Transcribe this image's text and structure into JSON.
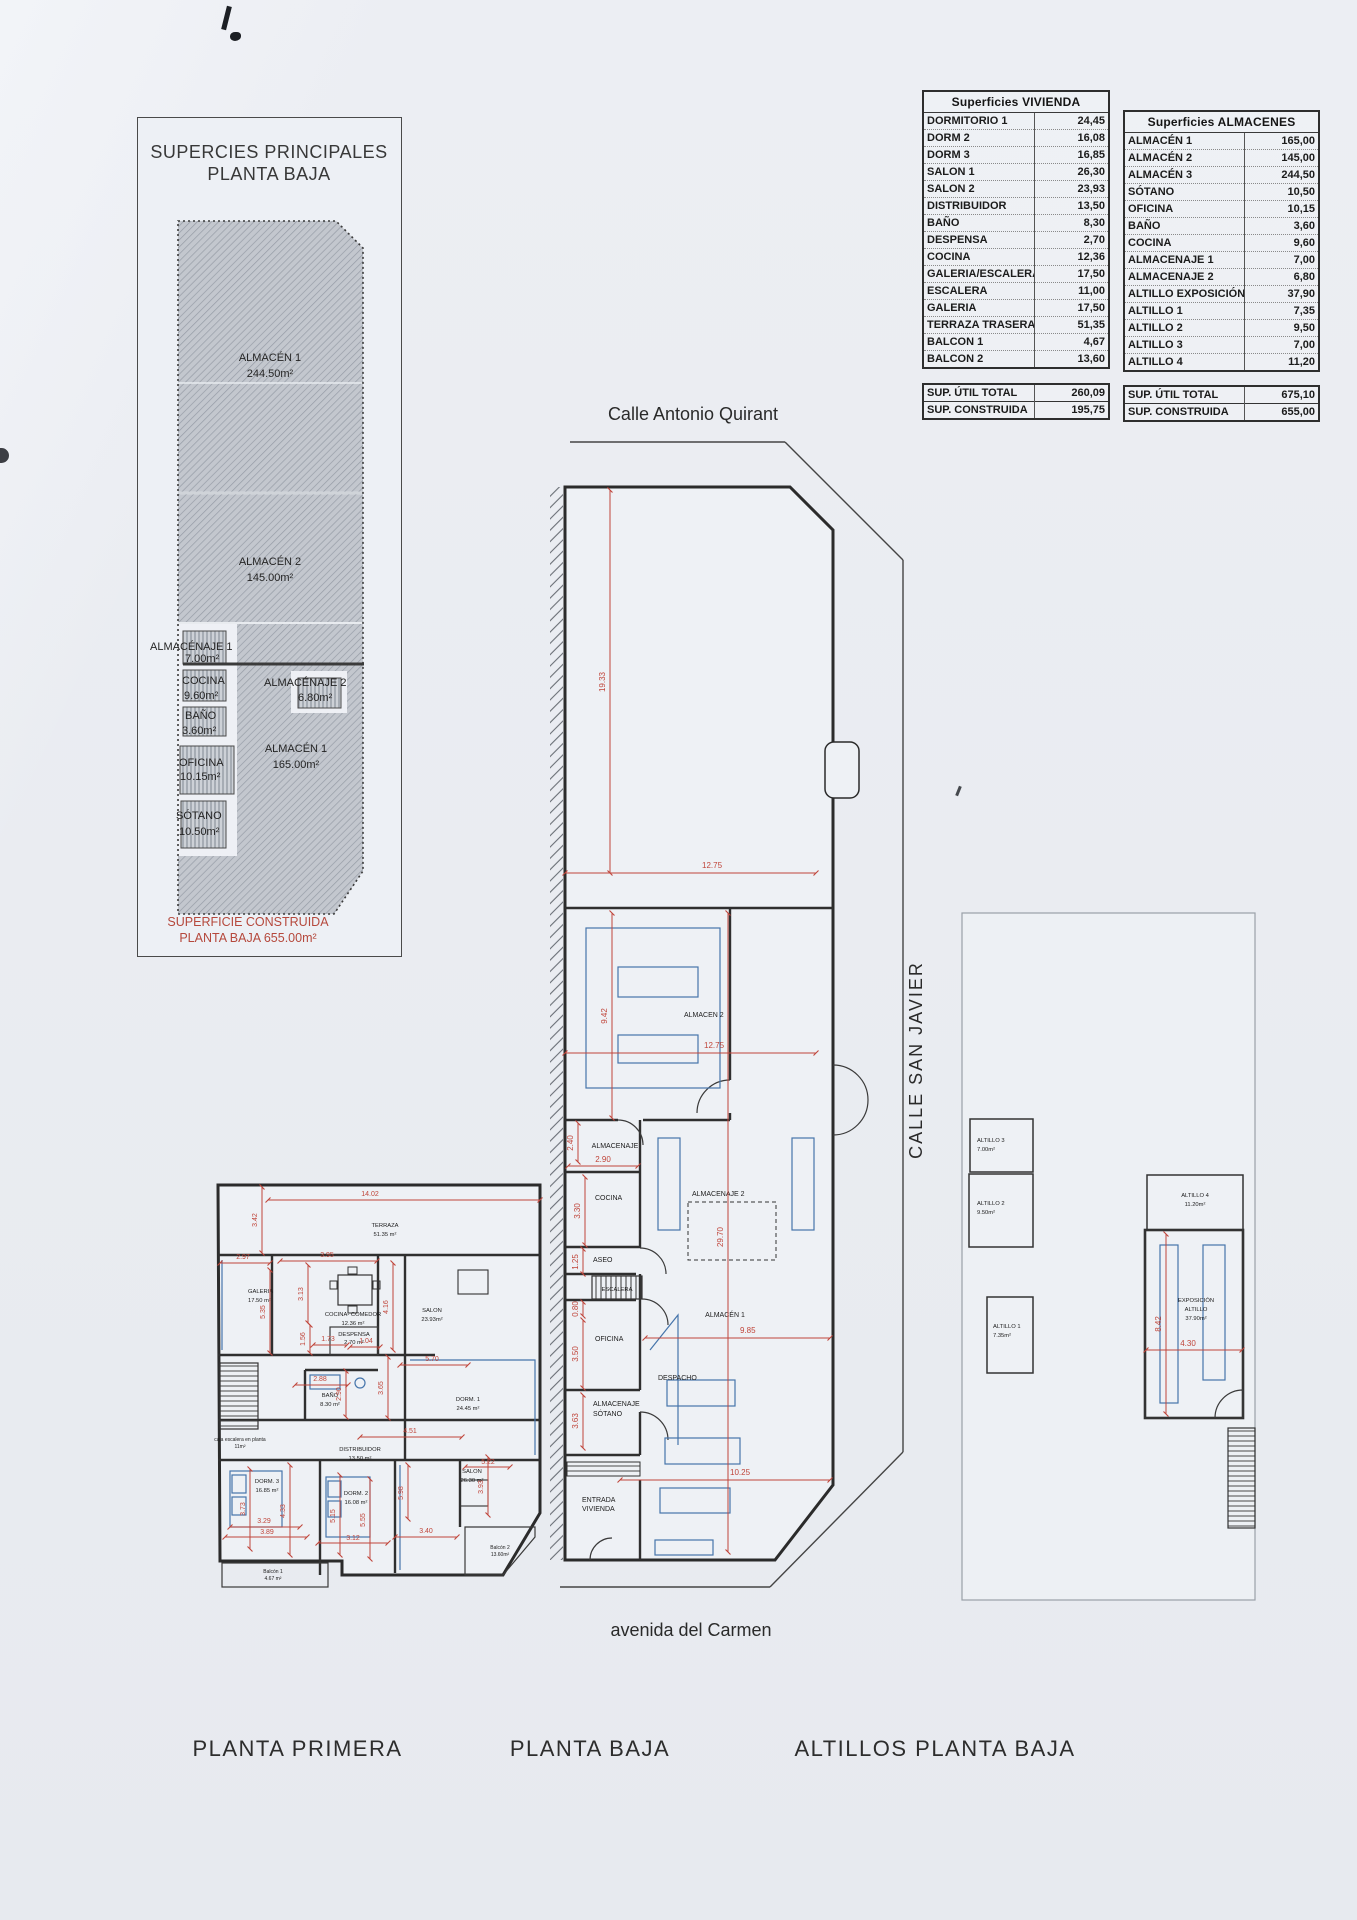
{
  "site_diagram": {
    "title1": "SUPERCIES PRINCIPALES",
    "title2": "PLANTA BAJA",
    "rooms": {
      "a1": {
        "name": "ALMACÉN 1",
        "area": "244.50m²"
      },
      "a2": {
        "name": "ALMACÉN 2",
        "area": "145.00m²"
      },
      "aje1": {
        "name": "ALMACÉNAJE 1",
        "area": "7.00m²"
      },
      "cocina": {
        "name": "COCINA",
        "area": "9.60m²"
      },
      "aje2": {
        "name": "ALMACÉNAJE 2",
        "area": "6.80m²"
      },
      "bano": {
        "name": "BAÑO",
        "area": "3.60m²"
      },
      "a1b": {
        "name": "ALMACÉN 1",
        "area": "165.00m²"
      },
      "oficina": {
        "name": "OFICINA",
        "area": "10.15m²"
      },
      "sotano": {
        "name": "SÓTANO",
        "area": "10.50m²"
      }
    },
    "footer1": "SUPERFICIE CONSTRUIDA",
    "footer2": "PLANTA BAJA 655.00m²"
  },
  "tables": {
    "vivienda": {
      "title": "Superficies VIVIENDA",
      "rows": [
        [
          "DORMITORIO 1",
          "24,45"
        ],
        [
          "DORM 2",
          "16,08"
        ],
        [
          "DORM 3",
          "16,85"
        ],
        [
          "SALON 1",
          "26,30"
        ],
        [
          "SALON 2",
          "23,93"
        ],
        [
          "DISTRIBUIDOR",
          "13,50"
        ],
        [
          "BAÑO",
          "8,30"
        ],
        [
          "DESPENSA",
          "2,70"
        ],
        [
          "COCINA",
          "12,36"
        ],
        [
          "GALERIA/ESCALERA",
          "17,50"
        ],
        [
          "ESCALERA",
          "11,00"
        ],
        [
          "GALERIA",
          "17,50"
        ],
        [
          "TERRAZA TRASERA",
          "51,35"
        ],
        [
          "BALCON 1",
          "4,67"
        ],
        [
          "BALCON 2",
          "13,60"
        ]
      ],
      "totals": [
        [
          "SUP. ÚTIL TOTAL",
          "260,09"
        ],
        [
          "SUP. CONSTRUIDA",
          "195,75"
        ]
      ]
    },
    "almacenes": {
      "title": "Superficies ALMACENES",
      "rows": [
        [
          "ALMACÉN 1",
          "165,00"
        ],
        [
          "ALMACÉN 2",
          "145,00"
        ],
        [
          "ALMACÉN 3",
          "244,50"
        ],
        [
          "SÓTANO",
          "10,50"
        ],
        [
          "OFICINA",
          "10,15"
        ],
        [
          "BAÑO",
          "3,60"
        ],
        [
          "COCINA",
          "9,60"
        ],
        [
          "ALMACENAJE 1",
          "7,00"
        ],
        [
          "ALMACENAJE 2",
          "6,80"
        ],
        [
          "ALTILLO EXPOSICIÓN",
          "37,90"
        ],
        [
          "ALTILLO 1",
          "7,35"
        ],
        [
          "ALTILLO 2",
          "9,50"
        ],
        [
          "ALTILLO 3",
          "7,00"
        ],
        [
          "ALTILLO 4",
          "11,20"
        ]
      ],
      "totals": [
        [
          "SUP. ÚTIL TOTAL",
          "675,10"
        ],
        [
          "SUP. CONSTRUIDA",
          "655,00"
        ]
      ]
    }
  },
  "streets": {
    "north": "Calle Antonio Quirant",
    "east": "CALLE SAN JAVIER",
    "south": "avenida del Carmen"
  },
  "plan_titles": {
    "left": "PLANTA PRIMERA",
    "middle": "PLANTA BAJA",
    "right": "ALTILLOS PLANTA BAJA"
  },
  "planta_baja": {
    "labels": {
      "almacen2": "ALMACEN 2",
      "almacenaje": "ALMACENAJE",
      "cocina": "COCINA",
      "aseo": "ASEO",
      "escalera": "ESCALERA",
      "oficina": "OFICINA",
      "despacho": "DESPACHO",
      "almacen1": "ALMACÉN 1",
      "almacenaje2": "ALMACENAJE 2",
      "alm_sotano_1": "ALMACENAJE",
      "alm_sotano_2": "SÓTANO",
      "entrada_1": "ENTRADA",
      "entrada_2": "VIVIENDA"
    },
    "dims": {
      "d1": "19.33",
      "d2": "12.75",
      "d3": "9.42",
      "d4": "12.75",
      "d5": "2.40",
      "d6": "2.90",
      "d7": "3.30",
      "d8": "1.25",
      "d9": "0.80",
      "d10": "3.50",
      "d11": "3.63",
      "d12": "29.70",
      "d13": "9.85",
      "d14": "10.25"
    }
  },
  "planta_primera": {
    "rooms": {
      "terraza": {
        "name": "TERRAZA",
        "area": "51.35 m²"
      },
      "galeria": {
        "name": "GALERIA",
        "area": "17.50 m²"
      },
      "cocina": {
        "name": "COCINA- COMEDOR",
        "area": "12.36 m²"
      },
      "salon1": {
        "name": "SALON",
        "area": "23.93m²"
      },
      "despensa": {
        "name": "DESPENSA",
        "area": "2.70 m²"
      },
      "bano": {
        "name": "BAÑO",
        "area": "8.30 m²"
      },
      "dorm1": {
        "name": "DORM. 1",
        "area": "24.45 m²"
      },
      "caja": {
        "name": "caja escalera en planta",
        "area": "11m²"
      },
      "distribuidor": {
        "name": "DISTRIBUIDOR",
        "area": "13.50 m²"
      },
      "dorm3": {
        "name": "DORM. 3",
        "area": "16.85 m²"
      },
      "dorm2": {
        "name": "DORM. 2",
        "area": "16.08 m²"
      },
      "salon2": {
        "name": "SALON",
        "area": "26.30 m²"
      },
      "balcon1": {
        "name": "Balcón 1",
        "area": "4.67 m²"
      },
      "balcon2": {
        "name": "Balcón 2",
        "area": "13.60m²"
      }
    },
    "dims": {
      "d1": "14.02",
      "d2": "3.42",
      "d3": "2.97",
      "d4": "3.95",
      "d5": "3.13",
      "d6": "5.35",
      "d7": "4.16",
      "d8": "1.56",
      "d9": "1.73",
      "d10": "1.04",
      "d11": "2.88",
      "d12": "2.90",
      "d13": "3.65",
      "d14": "5.70",
      "d15": "4.51",
      "d16": "3.73",
      "d17": "4.33",
      "d18": "3.29",
      "d19": "3.89",
      "d20": "5.15",
      "d21": "5.55",
      "d22": "3.12",
      "d23": "3.40",
      "d24": "3.93",
      "d25": "5.98",
      "d26": "5.22"
    }
  },
  "altillos": {
    "rooms": {
      "a3": {
        "name": "ALTILLO 3",
        "area": "7.00m²"
      },
      "a2": {
        "name": "ALTILLO 2",
        "area": "9.50m²"
      },
      "a1": {
        "name": "ALTILLO 1",
        "area": "7.35m²"
      },
      "a4": {
        "name": "ALTILLO 4",
        "area": "11.20m²"
      },
      "expo": {
        "l1": "EXPOSICIÓN",
        "l2": "ALTILLO",
        "area": "37.90m²"
      }
    },
    "dims": {
      "height": "8.42",
      "width": "4.30"
    }
  }
}
